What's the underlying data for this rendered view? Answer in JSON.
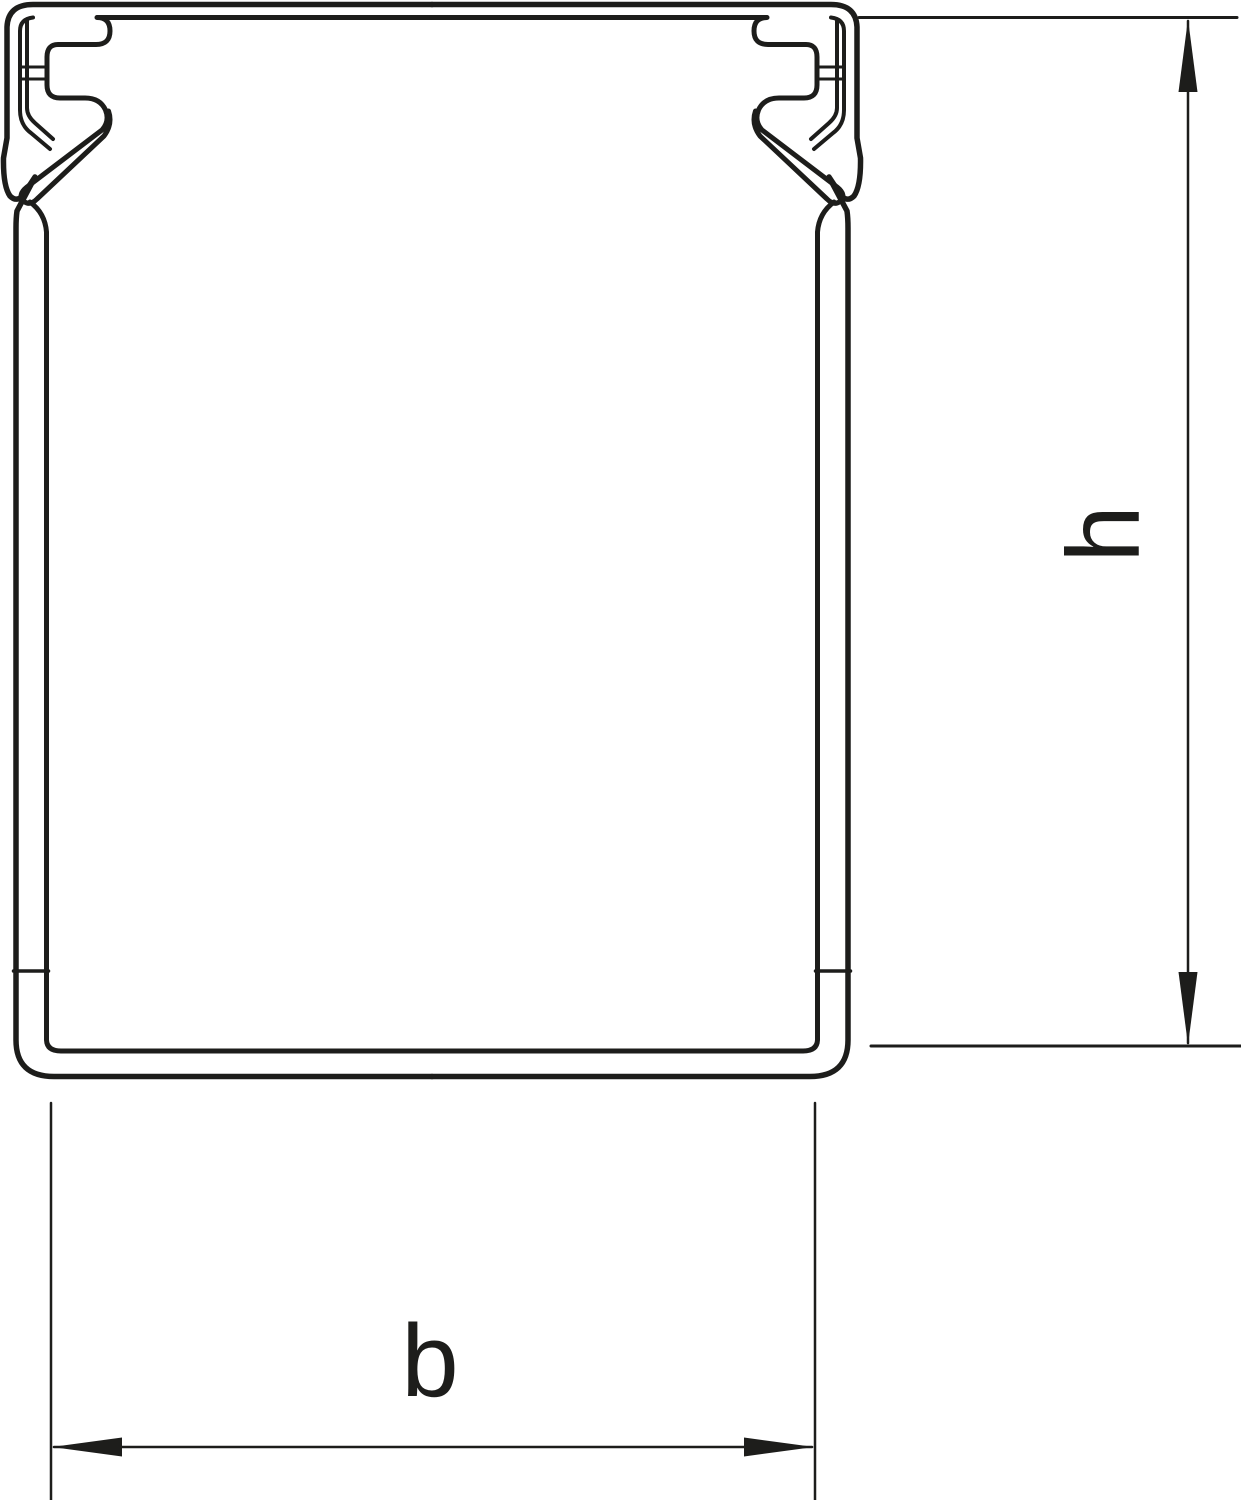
{
  "diagram": {
    "line_color": "#1d1d1b",
    "background_color": "#ffffff",
    "dimensions": {
      "height_label": "h",
      "width_label": "b"
    }
  }
}
